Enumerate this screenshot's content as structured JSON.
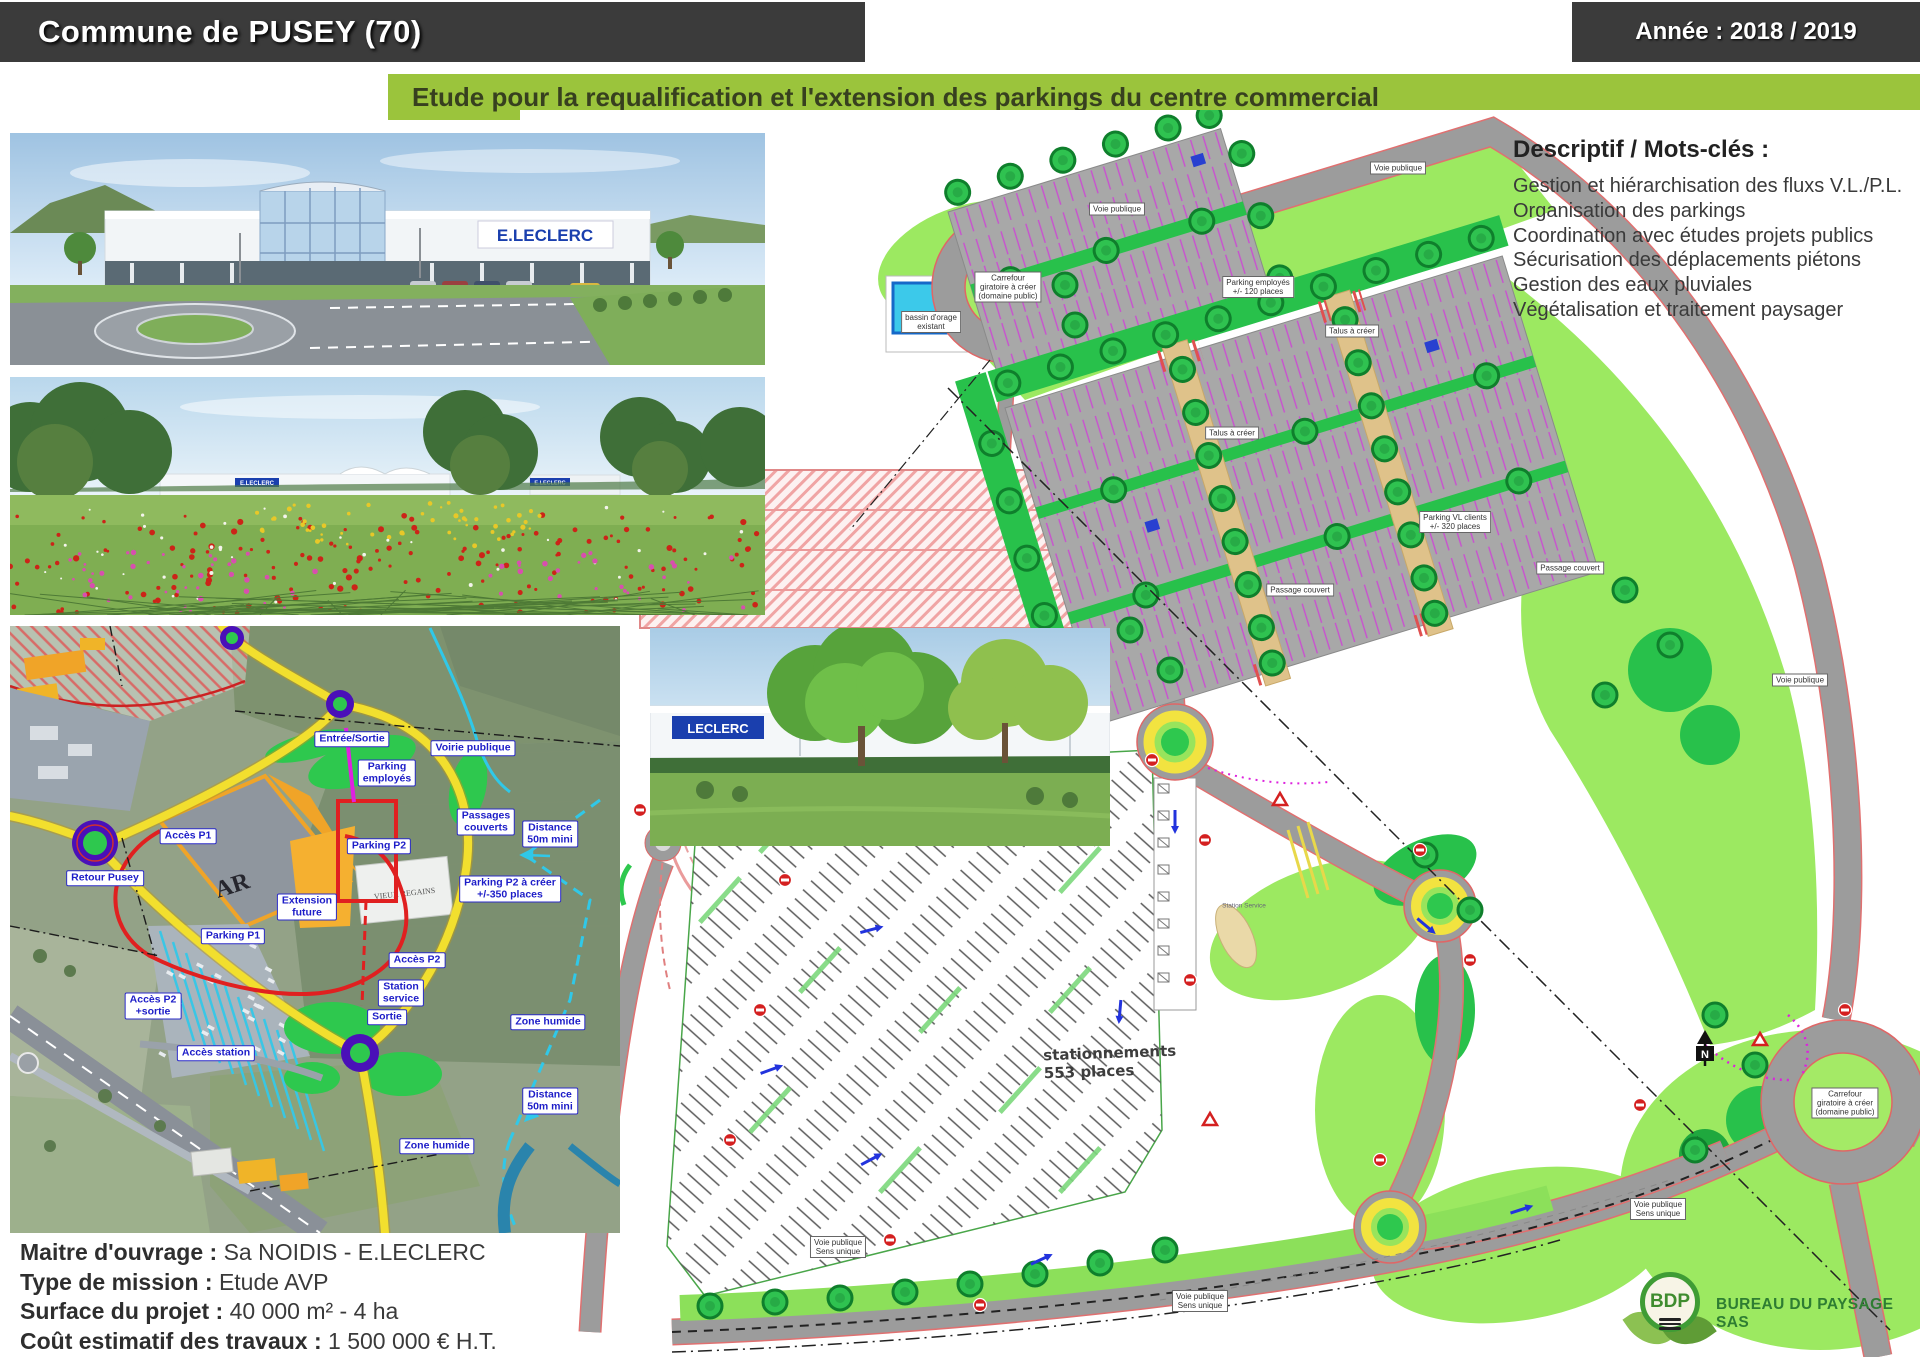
{
  "header": {
    "title": "Commune de PUSEY (70)",
    "year_label": "Année : 2018 / 2019",
    "banner": "Etude pour la requalification et l'extension des parkings du centre commercial"
  },
  "descriptif": {
    "title": "Descriptif / Mots-clés :",
    "items": [
      "Gestion et hiérarchisation des fluxs V.L./P.L.",
      "Organisation des parkings",
      "Coordination avec études projets publics",
      "Sécurisation des déplacements piétons",
      "Gestion des eaux pluviales",
      "Végétalisation et traitement paysager"
    ]
  },
  "project_info": {
    "lines": [
      {
        "label": "Maitre d'ouvrage :",
        "value": " Sa NOIDIS - E.LECLERC"
      },
      {
        "label": "Type de mission :",
        "value": " Etude AVP"
      },
      {
        "label": "Surface du projet :",
        "value": " 40 000 m² - 4 ha"
      },
      {
        "label": "Coût estimatif des travaux :",
        "value": " 1 500 000 € H.T."
      }
    ]
  },
  "logo": {
    "initials": "BDP",
    "company": "BUREAU DU PAYSAGE SAS"
  },
  "photos": {
    "storefront_sign": "E.LECLERC",
    "meadow_sign": "E.LECLERC",
    "meadow_sign2": "E.LECLERC",
    "inset_sign": "LECLERC"
  },
  "aerial_map": {
    "building_text": "AR",
    "building_name": "VIEUX REGAINS",
    "labels": [
      "Entrée/Sortie",
      "Voirie publique",
      "Parking\nemployés",
      "Passages\ncouverts",
      "Distance\n50m mini",
      "Parking P2",
      "Parking P2 à créer\n+/-350 places",
      "Extension\nfuture",
      "Parking P1",
      "Accès P2",
      "Station\nservice",
      "Accès P2\n+sortie",
      "Sortie",
      "Accès station",
      "Zone humide",
      "Distance\n50m mini",
      "Zone humide",
      "Retour Pusey",
      "Accès P1"
    ]
  },
  "site_plan": {
    "north_label": "N",
    "labels": [
      "Voie publique",
      "Voie publique",
      "Carrefour\ngiratoire à créer\n(domaine public)",
      "Parking employés\n+/- 120 places",
      "bassin d'orage\nexistant",
      "Talus à créer",
      "Talus à créer",
      "Parking VL clients\n+/- 320 places",
      "Passage couvert",
      "Passage couvert",
      "stationnements\n553 places",
      "Carrefour\ngiratoire à créer\n(domaine public)",
      "Voie publique",
      "Voie publique\nSens unique",
      "Voie publique\nSens unique",
      "Voie publique\nSens unique",
      "Station Service"
    ]
  }
}
